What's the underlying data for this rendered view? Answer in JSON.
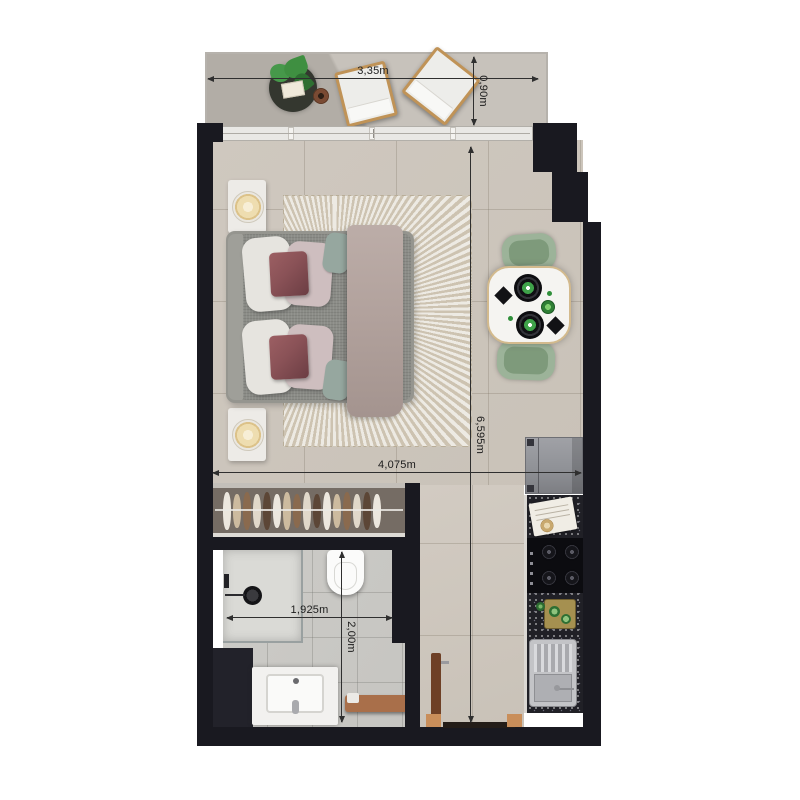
{
  "plan": {
    "type": "studio-apartment-floor-plan",
    "dimensions": {
      "balcony_width": "3,35m",
      "balcony_depth": "0,90m",
      "interior_length": "6,595m",
      "interior_width": "4,075m",
      "bathroom_width": "1,925m",
      "bathroom_depth": "2,00m"
    }
  },
  "palette": {
    "wall": "#191920",
    "floor_main": "#c9c2b8",
    "floor_balcony": "#b2ada6",
    "floor_bath": "#c6c5c1",
    "glass": "#e9e8e5",
    "rug": "#d8d0c0",
    "bed": "#8b8c87",
    "blanket": "#b2a29d",
    "pillow_accent": "#8a5257",
    "chair_green": "#9cb399",
    "table_white": "#f5f4f1",
    "plate_green": "#3fa24a",
    "counter": "#202026",
    "fridge": "#909297",
    "wood": "#a96f4a",
    "lamp": "#eeddb0",
    "plant": "#3f8f41",
    "dim": "#2f2f2f"
  }
}
